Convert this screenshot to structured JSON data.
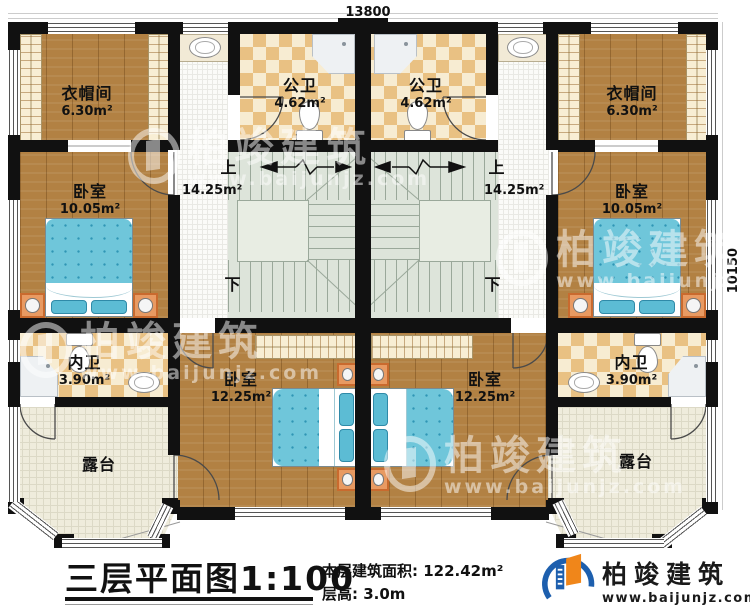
{
  "dimensions": {
    "top": "13800",
    "right": "10150"
  },
  "rooms": {
    "cloak_left": {
      "label": "衣帽间",
      "area": "6.30m²"
    },
    "cloak_right": {
      "label": "衣帽间",
      "area": "6.30m²"
    },
    "bath_pub_left": {
      "label": "公卫",
      "area": "4.62m²"
    },
    "bath_pub_right": {
      "label": "公卫",
      "area": "4.62m²"
    },
    "bed_left": {
      "label": "卧室",
      "area": "10.05m²"
    },
    "bed_right": {
      "label": "卧室",
      "area": "10.05m²"
    },
    "stair_left": {
      "up": "上",
      "down": "下",
      "area": "14.25m²"
    },
    "stair_right": {
      "up": "上",
      "down": "下",
      "area": "14.25m²"
    },
    "bath_priv_left": {
      "label": "内卫",
      "area": "3.90m²"
    },
    "bath_priv_right": {
      "label": "内卫",
      "area": "3.90m²"
    },
    "bed_bottom_left": {
      "label": "卧室",
      "area": "12.25m²"
    },
    "bed_bottom_right": {
      "label": "卧室",
      "area": "12.25m²"
    },
    "terrace_left": {
      "label": "露台"
    },
    "terrace_right": {
      "label": "露台"
    }
  },
  "title_block": {
    "title": "三层平面图",
    "scale": "1:100",
    "area_label": "本层建筑面积: 122.42m²",
    "height_label": "层高: 3.0m"
  },
  "logo": {
    "brand": "柏竣建筑",
    "url": "www.baijunjz.com"
  },
  "watermark": {
    "brand": "柏竣建筑",
    "url": "www.baijunjz.com"
  }
}
